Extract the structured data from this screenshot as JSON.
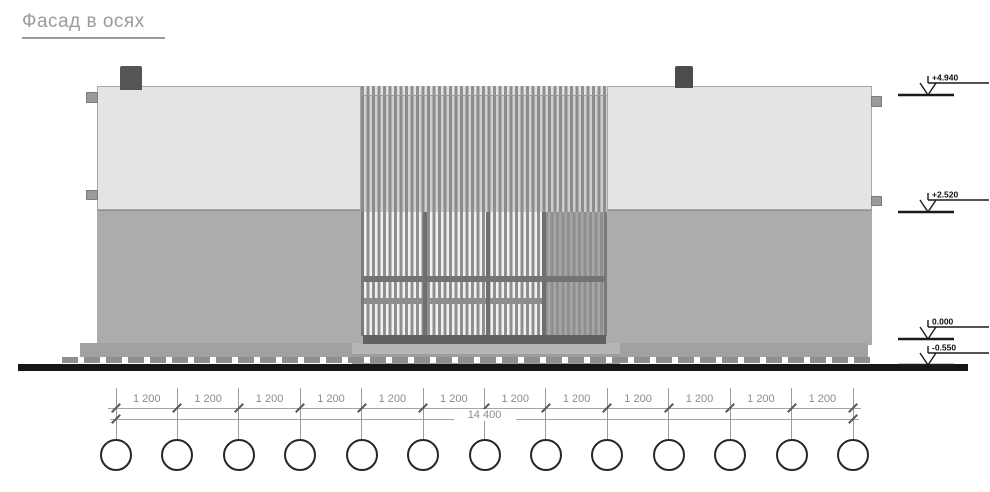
{
  "title": "Фасад в осях",
  "facade": {
    "upper_band_color": "#e4e4e4",
    "lower_band_color": "#acacac",
    "slat_color": "#8c8c8c",
    "ground_color": "#161616"
  },
  "elevation_markers": [
    {
      "value": "+4.940"
    },
    {
      "value": "+2.520"
    },
    {
      "value": "0.000"
    },
    {
      "value": "-0.550"
    }
  ],
  "dimension": {
    "segments": [
      "1 200",
      "1 200",
      "1 200",
      "1 200",
      "1 200",
      "1 200",
      "1 200",
      "1 200",
      "1 200",
      "1 200",
      "1 200",
      "1 200"
    ],
    "total": "14 400"
  },
  "axes": {
    "count": 13
  }
}
